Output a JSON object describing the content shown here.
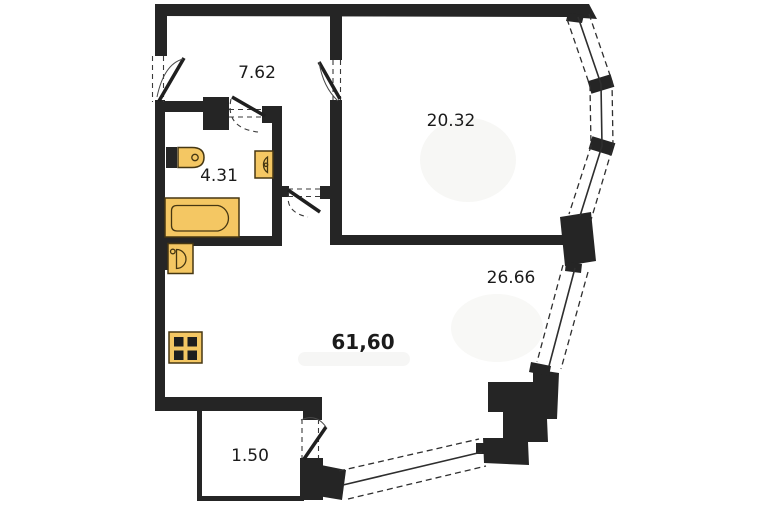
{
  "floor_plan": {
    "rooms": {
      "hallway": {
        "area_label": "7.62"
      },
      "room_top_right": {
        "area_label": "20.32"
      },
      "bathroom": {
        "area_label": "4.31"
      },
      "living": {
        "area_label": "26.66"
      },
      "total": {
        "area_label": "61,60"
      },
      "balcony": {
        "area_label": "1.50"
      }
    },
    "colors": {
      "walls": "#252525",
      "fixtures": "#F4C763",
      "fixture_outline": "#463712",
      "background": "#ffffff",
      "text": "#1b1b1b"
    }
  }
}
